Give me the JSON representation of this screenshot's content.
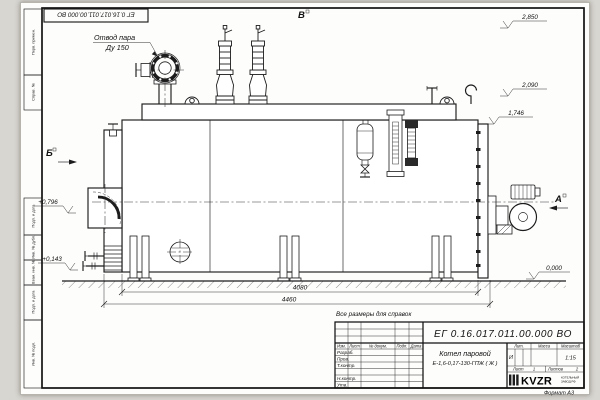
{
  "frame": {
    "doc_number_top": "ЕГ 0.16.017.011.00.000  ВО",
    "margin_labels": [
      "Перв. примен.",
      "Справ. №",
      "Подп. и дата",
      "Инв. № дубл.",
      "Взам. инв. №",
      "Подп. и дата",
      "Инв. № подл."
    ],
    "format_label": "Формат А3"
  },
  "drawing": {
    "callout_line1": "Отвод пара",
    "callout_line2": "Ду 150",
    "view_marker_b": "Б",
    "view_marker_v": "В",
    "view_marker_a": "А",
    "elev_2850": "2,850",
    "elev_2090": "2,090",
    "elev_1746": "1,746",
    "elev_0796": "+0,796",
    "elev_0143": "+0,143",
    "elev_0000": "0,000",
    "dim_shell_length": "4080",
    "dim_overall_length": "4460",
    "note": "Все размеры для справок"
  },
  "title_block": {
    "doc_number": "ЕГ 0.16.017.011.00.000  ВО",
    "product_name": "Котел паровой",
    "product_designation": "Е-1,6-0,17-130-ГПЖ ( Ж )",
    "col_izm": "Изм.",
    "col_list": "Лист",
    "col_docnum": "№ докум.",
    "col_podp": "Подп.",
    "col_data": "Дата",
    "row_razrab": "Разраб.",
    "row_prov": "Пров.",
    "row_tkontr": "Т.контр.",
    "row_nkontr": "Н.контр.",
    "row_utv": "Утв.",
    "lit_label": "Лит.",
    "lit_value": "И",
    "mass_label": "Масса",
    "scale_label": "Масштаб",
    "scale_value": "1:15",
    "sheet_label": "Лист",
    "sheet_value": "1",
    "sheets_label": "Листов",
    "sheets_value": "2",
    "logo_text": "KVZR",
    "logo_caption_1": "КОТЕЛЬНЫЙ",
    "logo_caption_2": "ЗАВОД РФ"
  }
}
